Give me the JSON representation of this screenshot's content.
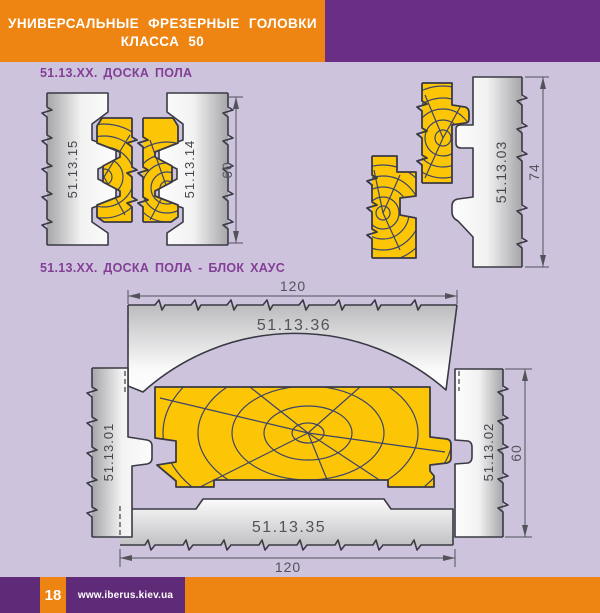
{
  "header": {
    "line1": "УНИВЕРСАЛЬНЫЕ ФРЕЗЕРНЫЕ ГОЛОВКИ",
    "line2": "КЛАССА 50"
  },
  "sections": {
    "floor_board": {
      "title": "51.13.XX.  ДОСКА ПОЛА",
      "pair": {
        "cutter_left_label": "51.13.15",
        "cutter_right_label": "51.13.14",
        "height_dim": "60"
      },
      "side": {
        "cutter_label": "51.13.03",
        "height_dim": "74"
      }
    },
    "block_house": {
      "title": "51.13.XX.  ДОСКА ПОЛА - БЛОК ХАУС",
      "top_cutter_label": "51.13.36",
      "bottom_cutter_label": "51.13.35",
      "left_cutter_label": "51.13.01",
      "right_cutter_label": "51.13.02",
      "top_width_dim": "120",
      "bottom_width_dim": "120",
      "height_dim": "60"
    }
  },
  "footer": {
    "page_number": "18",
    "site_url": "www.iberus.kiev.ua"
  },
  "colors": {
    "banner_orange": "#ee8412",
    "header_purple": "#6b2e87",
    "footer_purple": "#5f2b78",
    "background_lavender": "#cec3dd",
    "wood_yellow": "#fcc607",
    "title_purple": "#833f96",
    "drawing_outline": "#3a3a44",
    "grain_navy": "#3c4468"
  }
}
